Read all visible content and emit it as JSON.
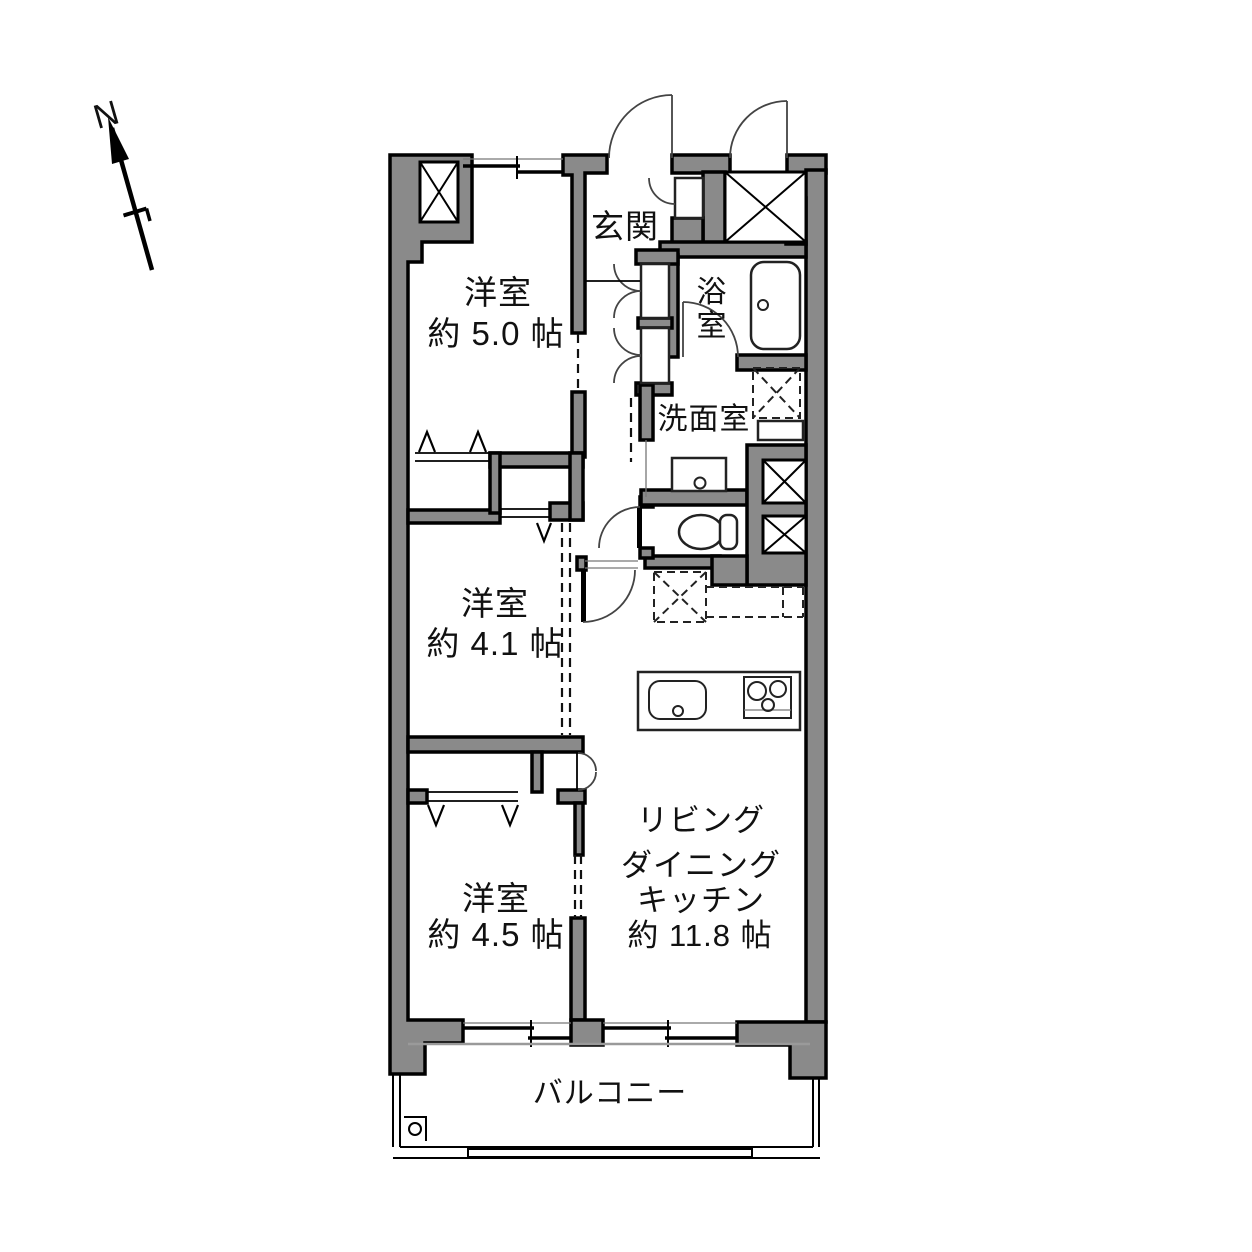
{
  "compass": {
    "north": "N"
  },
  "rooms": {
    "bedroom_5": {
      "name": "洋室",
      "size": "約 5.0 帖"
    },
    "bedroom_41": {
      "name": "洋室",
      "size": "約 4.1 帖"
    },
    "bedroom_45": {
      "name": "洋室",
      "size": "約 4.5 帖"
    },
    "ldk": {
      "name_line1": "リビング",
      "name_line2": "ダイニング",
      "name_line3": "キッチン",
      "size": "約 11.8 帖"
    },
    "entrance": {
      "name": "玄関"
    },
    "bathroom": {
      "name": "浴室",
      "vertical_char_1": "浴",
      "vertical_char_2": "室"
    },
    "washroom": {
      "name": "洗面室"
    },
    "balcony": {
      "name": "バルコニー"
    }
  },
  "colors": {
    "wall": "#8a8a8a",
    "line": "#000000",
    "text": "#111111",
    "bg": "#ffffff"
  }
}
